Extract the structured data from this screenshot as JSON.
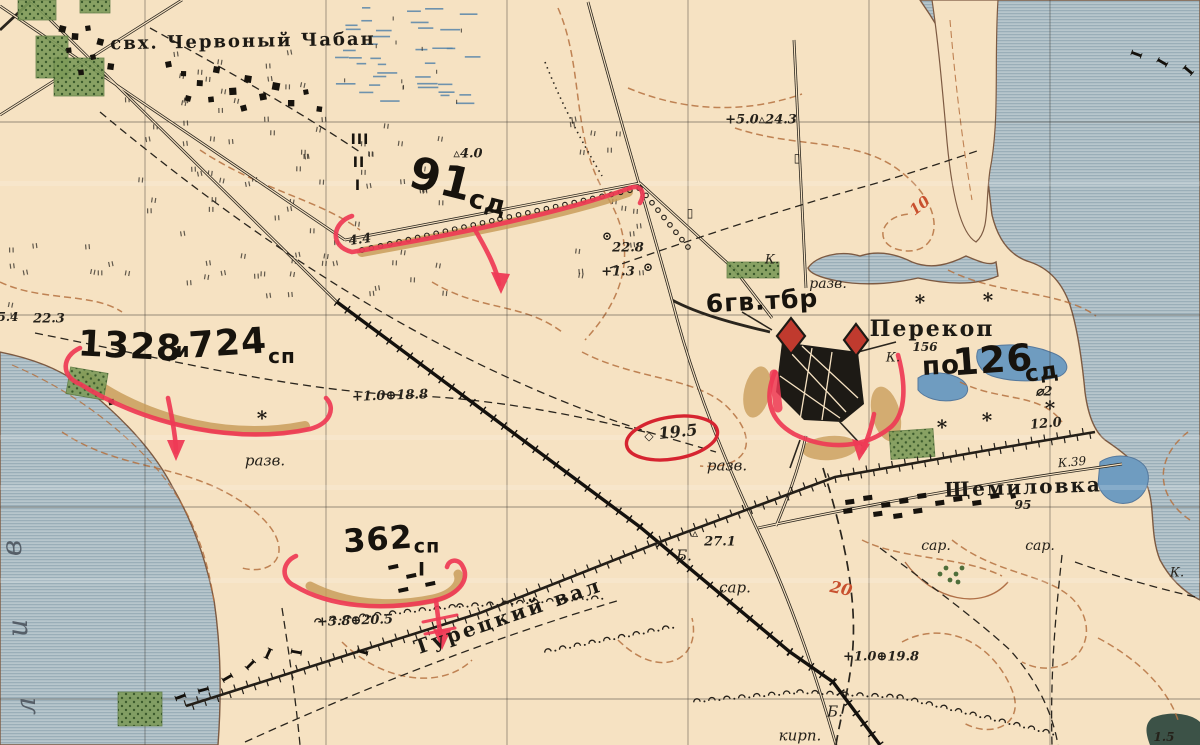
{
  "palette": {
    "parchment": "#f6e2c2",
    "water_base": "#b7c6cc",
    "water_stripe": "#93a9b4",
    "lake_blue": "#6f9cc0",
    "ink": "#241f18",
    "contour_brown": "#b5713f",
    "front_line_red": "#ee3a55",
    "annotation_red": "#d62430",
    "rampart_tan": "#c79a55",
    "orchard_green": "#7d9b59"
  },
  "map_labels": [
    {
      "t": "свх. Червоный Чабан",
      "x": 243,
      "y": 42,
      "s": 18,
      "r": -1,
      "k": "place",
      "n": "label-sovkhoz-chervony-chaban"
    },
    {
      "t": "Перекоп",
      "x": 932,
      "y": 329,
      "s": 22,
      "r": 0,
      "k": "place",
      "n": "label-perekop"
    },
    {
      "t": "156",
      "x": 925,
      "y": 347,
      "s": 12,
      "r": 0,
      "k": "num",
      "n": "label-elev-156"
    },
    {
      "t": "Щемиловка",
      "x": 1023,
      "y": 487,
      "s": 20,
      "r": -2,
      "k": "place",
      "n": "label-shchemilovka"
    },
    {
      "t": "95",
      "x": 1023,
      "y": 505,
      "s": 12,
      "r": 0,
      "k": "num",
      "n": "label-elev-95"
    },
    {
      "t": "Турецкий вал",
      "x": 508,
      "y": 616,
      "s": 20,
      "r": -19,
      "k": "vall",
      "n": "label-turetsky-val"
    },
    {
      "t": "разв.",
      "x": 265,
      "y": 461,
      "s": 15,
      "r": 0,
      "k": "small",
      "n": "label-ruins-1"
    },
    {
      "t": "разв.",
      "x": 727,
      "y": 466,
      "s": 15,
      "r": 0,
      "k": "small",
      "n": "label-ruins-2"
    },
    {
      "t": "разв.",
      "x": 828,
      "y": 284,
      "s": 14,
      "r": 0,
      "k": "small",
      "n": "label-ruins-3"
    },
    {
      "t": "сар.",
      "x": 735,
      "y": 588,
      "s": 15,
      "r": 0,
      "k": "small",
      "n": "label-barn-1"
    },
    {
      "t": "сар.",
      "x": 936,
      "y": 546,
      "s": 14,
      "r": 0,
      "k": "small",
      "n": "label-barn-2"
    },
    {
      "t": "сар.",
      "x": 1040,
      "y": 546,
      "s": 14,
      "r": 0,
      "k": "small",
      "n": "label-barn-3"
    },
    {
      "t": "кирп.",
      "x": 800,
      "y": 736,
      "s": 15,
      "r": 0,
      "k": "small",
      "n": "label-brickworks"
    },
    {
      "t": "Б.",
      "x": 684,
      "y": 556,
      "s": 15,
      "r": 0,
      "k": "small",
      "n": "label-b-mound-1"
    },
    {
      "t": "Б.",
      "x": 835,
      "y": 712,
      "s": 15,
      "r": 0,
      "k": "small",
      "n": "label-b-mound-2"
    },
    {
      "t": "К.",
      "x": 772,
      "y": 260,
      "s": 13,
      "r": 0,
      "k": "small",
      "n": "label-k-1"
    },
    {
      "t": "К.",
      "x": 893,
      "y": 358,
      "s": 13,
      "r": 0,
      "k": "small",
      "n": "label-k-2"
    },
    {
      "t": "К.39",
      "x": 1072,
      "y": 462,
      "s": 12,
      "r": -5,
      "k": "small",
      "n": "label-k-39"
    },
    {
      "t": "К.",
      "x": 1177,
      "y": 573,
      "s": 13,
      "r": 0,
      "k": "small",
      "n": "label-k-3"
    },
    {
      "t": "1.5",
      "x": 1164,
      "y": 737,
      "s": 12,
      "r": 0,
      "k": "num",
      "n": "label-elev-1-5"
    },
    {
      "t": "4.4",
      "x": 360,
      "y": 240,
      "s": 13,
      "r": -8,
      "k": "num",
      "n": "label-elev-4-4"
    },
    {
      "t": "5.4",
      "x": 8,
      "y": 317,
      "s": 12,
      "r": 0,
      "k": "num",
      "n": "label-elev-5-4"
    },
    {
      "t": "22.3",
      "x": 49,
      "y": 319,
      "s": 13,
      "r": 0,
      "k": "num",
      "n": "label-elev-22-3"
    },
    {
      "t": "+5.0▵24.3",
      "x": 761,
      "y": 120,
      "s": 13,
      "r": 0,
      "k": "num",
      "n": "label-elev-24-3"
    },
    {
      "t": "▵4.0",
      "x": 468,
      "y": 154,
      "s": 13,
      "r": 0,
      "k": "num",
      "n": "label-elev-4-0"
    },
    {
      "t": "22.8",
      "x": 628,
      "y": 248,
      "s": 13,
      "r": 0,
      "k": "num",
      "n": "label-elev-22-8"
    },
    {
      "t": "+1.3",
      "x": 618,
      "y": 272,
      "s": 13,
      "r": 0,
      "k": "num",
      "n": "label-elev-1-3"
    },
    {
      "t": "+1.0⊕18.8",
      "x": 390,
      "y": 396,
      "s": 13,
      "r": -2,
      "k": "num",
      "n": "label-elev-18-8"
    },
    {
      "t": "19.5",
      "x": 678,
      "y": 432,
      "s": 16,
      "r": -6,
      "k": "num",
      "n": "label-elev-19-5"
    },
    {
      "t": "27.1",
      "x": 720,
      "y": 542,
      "s": 13,
      "r": 0,
      "k": "num",
      "n": "label-elev-27-1"
    },
    {
      "t": "+3.8⊕20.5",
      "x": 355,
      "y": 621,
      "s": 13,
      "r": -2,
      "k": "num",
      "n": "label-elev-20-5"
    },
    {
      "t": "+1.0⊕19.8",
      "x": 881,
      "y": 657,
      "s": 13,
      "r": 0,
      "k": "num",
      "n": "label-elev-19-8"
    },
    {
      "t": "12.0",
      "x": 1046,
      "y": 424,
      "s": 13,
      "r": -5,
      "k": "num",
      "n": "label-elev-12-0"
    },
    {
      "t": "⌀2",
      "x": 1044,
      "y": 392,
      "s": 13,
      "r": 0,
      "k": "num",
      "n": "label-point-2"
    },
    {
      "t": "10",
      "x": 920,
      "y": 206,
      "s": 15,
      "r": -38,
      "k": "red",
      "n": "label-contour-10"
    },
    {
      "t": "20",
      "x": 841,
      "y": 589,
      "s": 16,
      "r": 12,
      "k": "red",
      "n": "label-contour-20"
    },
    {
      "t": "91",
      "x": 441,
      "y": 180,
      "s": 44,
      "r": 14,
      "k": "unit",
      "n": "unit-91sd-number"
    },
    {
      "t": "сд",
      "x": 488,
      "y": 203,
      "s": 26,
      "r": 14,
      "k": "unit",
      "n": "unit-91sd-suffix"
    },
    {
      "t": "1328",
      "x": 130,
      "y": 347,
      "s": 36,
      "r": 3,
      "k": "unit",
      "n": "unit-1328sp-number"
    },
    {
      "t": "и",
      "x": 183,
      "y": 350,
      "s": 20,
      "r": 0,
      "k": "unit",
      "n": "unit-and"
    },
    {
      "t": "724",
      "x": 228,
      "y": 344,
      "s": 36,
      "r": -4,
      "k": "unit",
      "n": "unit-724sp-number"
    },
    {
      "t": "сп",
      "x": 282,
      "y": 356,
      "s": 20,
      "r": 0,
      "k": "unit",
      "n": "unit-724sp-suffix"
    },
    {
      "t": "362",
      "x": 378,
      "y": 539,
      "s": 32,
      "r": -4,
      "k": "unit",
      "n": "unit-362sp-number"
    },
    {
      "t": "сп",
      "x": 427,
      "y": 547,
      "s": 19,
      "r": 0,
      "k": "unit",
      "n": "unit-362sp-suffix"
    },
    {
      "t": "I",
      "x": 422,
      "y": 570,
      "s": 19,
      "r": 0,
      "k": "unit",
      "n": "unit-362-battalion-mark"
    },
    {
      "t": "III",
      "x": 360,
      "y": 140,
      "s": 14,
      "r": 0,
      "k": "unit",
      "n": "unit-mark-iii"
    },
    {
      "t": "II",
      "x": 359,
      "y": 163,
      "s": 14,
      "r": 0,
      "k": "unit",
      "n": "unit-mark-ii"
    },
    {
      "t": "I",
      "x": 358,
      "y": 186,
      "s": 14,
      "r": 0,
      "k": "unit",
      "n": "unit-mark-i"
    },
    {
      "t": "6гв.тбр",
      "x": 762,
      "y": 301,
      "s": 25,
      "r": -3,
      "k": "unit",
      "n": "unit-6gv-tbr"
    },
    {
      "t": "по",
      "x": 941,
      "y": 366,
      "s": 26,
      "r": -3,
      "k": "unit",
      "n": "unit-po"
    },
    {
      "t": "126",
      "x": 993,
      "y": 360,
      "s": 37,
      "r": -4,
      "k": "unit",
      "n": "unit-126sd-number"
    },
    {
      "t": "сд",
      "x": 1042,
      "y": 373,
      "s": 23,
      "r": -8,
      "k": "unit",
      "n": "unit-126sd-suffix"
    },
    {
      "t": "в",
      "x": 12,
      "y": 548,
      "s": 28,
      "r": -90,
      "k": "bay",
      "n": "label-bay-letter-v"
    },
    {
      "t": "и",
      "x": 18,
      "y": 628,
      "s": 28,
      "r": -90,
      "k": "bay",
      "n": "label-bay-letter-i"
    },
    {
      "t": "л",
      "x": 26,
      "y": 706,
      "s": 28,
      "r": -90,
      "k": "bay",
      "n": "label-bay-letter-l"
    }
  ],
  "map_symbols": [
    {
      "g": "star",
      "x": 262,
      "y": 418
    },
    {
      "g": "star",
      "x": 920,
      "y": 302
    },
    {
      "g": "star",
      "x": 988,
      "y": 300
    },
    {
      "g": "star",
      "x": 942,
      "y": 427
    },
    {
      "g": "star",
      "x": 987,
      "y": 420
    },
    {
      "g": "star",
      "x": 1050,
      "y": 408
    },
    {
      "g": "well",
      "x": 607,
      "y": 236
    },
    {
      "g": "well",
      "x": 648,
      "y": 267
    },
    {
      "g": "point",
      "x": 649,
      "y": 436
    },
    {
      "g": "mound",
      "x": 695,
      "y": 533
    },
    {
      "g": "hut",
      "x": 690,
      "y": 213
    },
    {
      "g": "hut",
      "x": 797,
      "y": 158
    }
  ],
  "symbol_glyphs": {
    "star": "*",
    "well": "⊙",
    "point": "◇",
    "mound": "▵",
    "hut": "▯",
    "boundary": "I"
  },
  "boundary_marks": [
    {
      "x": 180,
      "y": 697,
      "r": 70
    },
    {
      "x": 203,
      "y": 690,
      "r": 75
    },
    {
      "x": 227,
      "y": 678,
      "r": 60
    },
    {
      "x": 250,
      "y": 665,
      "r": 45
    },
    {
      "x": 268,
      "y": 654,
      "r": 25
    },
    {
      "x": 296,
      "y": 652,
      "r": 100
    },
    {
      "x": 362,
      "y": 652,
      "r": 105
    },
    {
      "x": 1136,
      "y": 54,
      "r": 110
    },
    {
      "x": 1162,
      "y": 62,
      "r": 120
    },
    {
      "x": 1188,
      "y": 70,
      "r": 130
    }
  ]
}
